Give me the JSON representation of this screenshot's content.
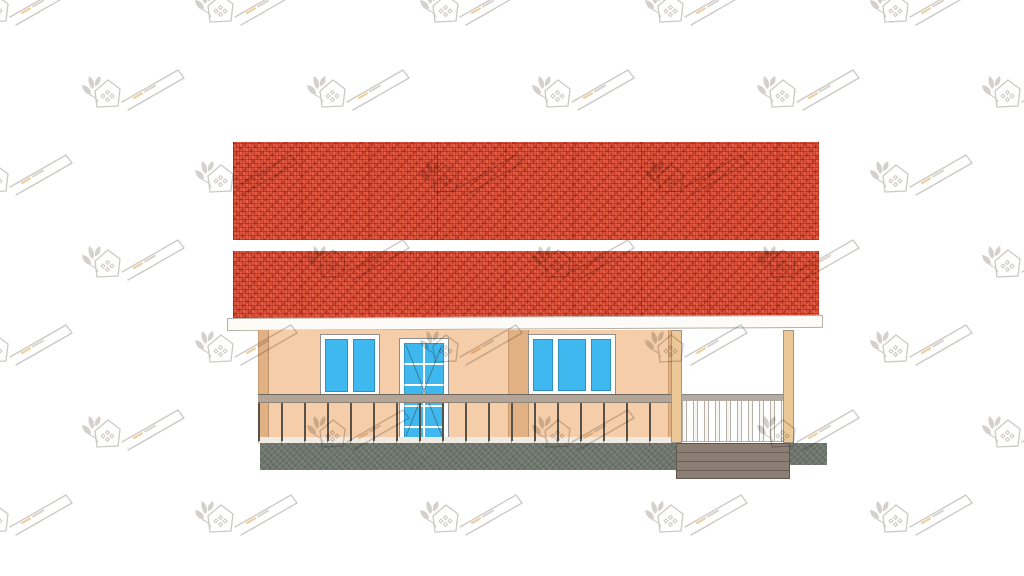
{
  "scene": {
    "description": "Front elevation drawing of a single-storey house: red tiled gable roof in two bands, white fascia, peach walls with tan trims, blue glazed windows and entrance door, veranda railing, open porch with posts and wooden steps, concrete plinth, repeating faint logo watermarks",
    "background": "#ffffff"
  },
  "colors": {
    "roof-red": "#dd4f38",
    "roof-dark": "#9e2a1a",
    "roof-light": "#f08066",
    "fascia": "#fcfbf7",
    "fascia-border": "#b6b0a6",
    "wall": "#f5cda9",
    "trim": "#e2b183",
    "glass": "#3fb8ef",
    "frame-white": "#ffffff",
    "rail-top": "#b2a496",
    "baluster-dark": "#56524a",
    "baluster-light": "#f8f7f4",
    "post": "#ecc897",
    "foundation": "#6e766d",
    "steps": "#8d7e73",
    "deck-strip": "#f0ebe2",
    "watermark-gray": "#9a948b",
    "watermark-accent": "#dfa13e"
  },
  "house": {
    "roof_bands": 2,
    "left_window_panes": 2,
    "right_window_panes": 3,
    "door_glass_columns": 2,
    "door_glass_rows": 5,
    "left_railing_balusters": 18,
    "porch_railing_balusters": 10,
    "porch_posts": 2,
    "step_planks": 4
  },
  "watermark": {
    "grid": {
      "cols": 6,
      "rows": 7,
      "dx": 225,
      "dy": 85,
      "startX": -30,
      "startY": -25,
      "oddRowOffset": 112
    },
    "opacity": 0.5
  }
}
